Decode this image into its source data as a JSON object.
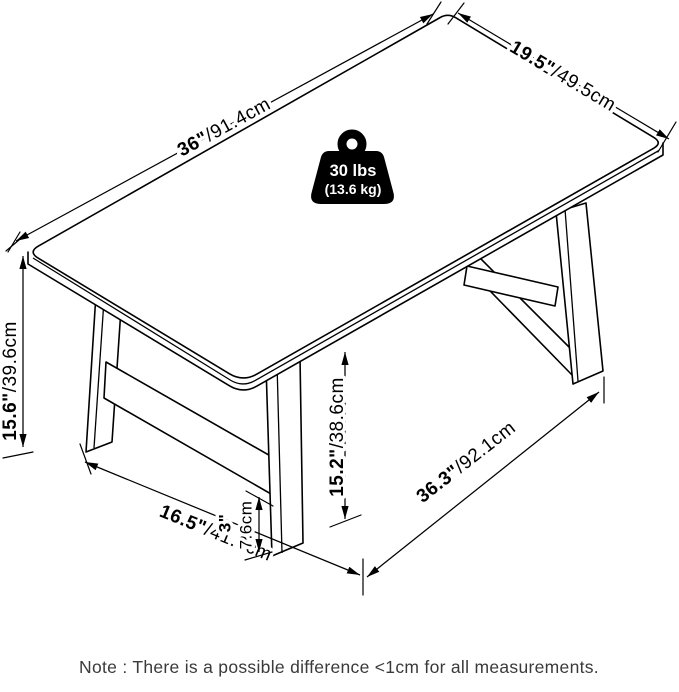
{
  "diagram": {
    "product": "trestle coffee table dimension diagram",
    "line_color": "#000000",
    "background": "#ffffff",
    "dims": {
      "length_top": {
        "in": "36\"",
        "cm": "/91.4cm"
      },
      "depth_top": {
        "in": "19.5\"",
        "cm": "/49.5cm"
      },
      "height": {
        "in": "15.6\"",
        "cm": "/39.6cm"
      },
      "leg_depth_span": {
        "in": "16.5\"",
        "cm": "/41.9cm"
      },
      "stretcher_clearance_in": "3\"",
      "stretcher_clearance_cm": "7.6cm",
      "under_clearance": {
        "in": "15.2\"",
        "cm": "/38.6cm"
      },
      "leg_length_span": {
        "in": "36.3\"",
        "cm": "/92.1cm"
      }
    },
    "weight_badge": {
      "lbs": "30 lbs",
      "kg": "(13.6 kg)"
    },
    "note": "Note : There is a possible difference <1cm for all measurements."
  }
}
